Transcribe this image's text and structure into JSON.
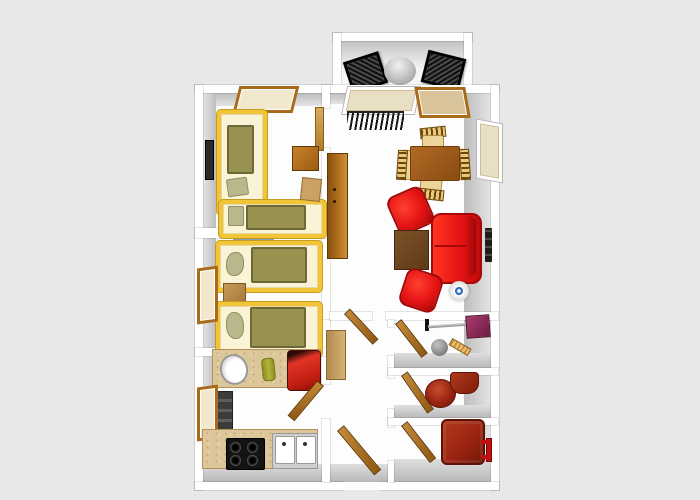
{
  "scene": {
    "kind": "3d-floor-plan-top-view",
    "description": "Rendered bird's-eye floor plan of a two-bedroom apartment with balcony"
  },
  "palette": {
    "background": "#e8e8e8",
    "wall_white": "#ffffff",
    "wall_inner_face_gray": "#c7c7c7",
    "floor_white": "#fdfdfd",
    "bed_frame_yellow": "#f2c437",
    "bed_linen_cream": "#faf3d6",
    "blanket_olive": "#99914f",
    "pillow_sage": "#b9b88c",
    "door_window_wood": "#a96b1a",
    "sofa_armchair_red": "#e61414",
    "bath_fixture_dark_red": "#992312",
    "kitchen_counter_tan": "#dcc79a",
    "dining_table_brown": "#9c5a1e",
    "coffee_table_brown": "#6e4520",
    "mop_head_purple": "#8e2a5a",
    "radiator_black": "#1c1c1c",
    "lamp_accent_blue": "#2a6fc9",
    "balcony_chair_black": "#1a1a1a",
    "balcony_table_silver": "#c9c9c9"
  },
  "inventory": {
    "rooms": [
      "balcony",
      "bedroom-1",
      "bedroom-2",
      "living-room",
      "kitchen",
      "hallway",
      "storage",
      "wc",
      "bathroom"
    ],
    "balcony": [
      "lounge-chair x2",
      "round-table"
    ],
    "bedroom_1": [
      "single-bed x2",
      "window",
      "nightstand",
      "small-cabinet",
      "wall-mirror",
      "open-door"
    ],
    "bedroom_2": [
      "single-bed x2",
      "nightstand",
      "window",
      "striped-doorway-rug"
    ],
    "living_room": [
      "window x2",
      "balcony-door",
      "radiator x2",
      "wardrobe",
      "dining-table",
      "dining-chair x4",
      "armchair x2",
      "sofa",
      "coffee-table",
      "round-floor-lamp"
    ],
    "kitchen": [
      "counter-with-basin",
      "bottle",
      "red-minibar-cube",
      "refrigerator",
      "window",
      "counter-with-cooktop-and-double-sink",
      "open-door"
    ],
    "hallway": [
      "cabinet",
      "entrance-door",
      "open-door x2"
    ],
    "storage": [
      "open-door",
      "mop",
      "bucket-ball",
      "hand-brush"
    ],
    "wc": [
      "open-door",
      "round-basin",
      "toilet"
    ],
    "bathroom": [
      "open-door",
      "bathtub",
      "towel-rail"
    ]
  }
}
